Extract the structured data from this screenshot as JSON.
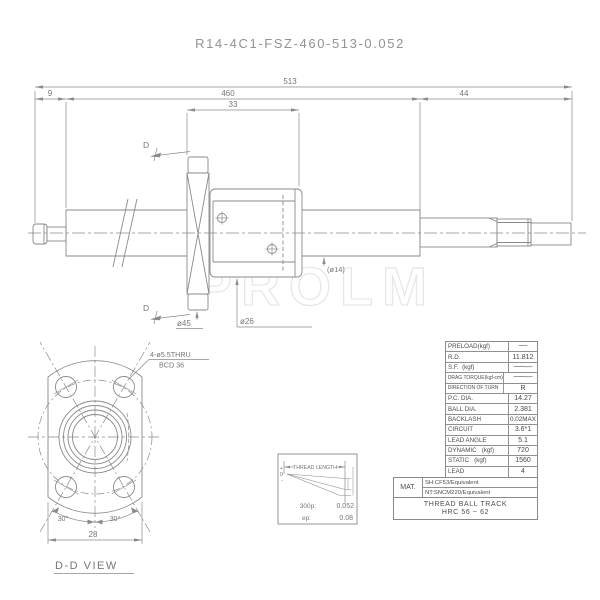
{
  "title": "R14-4C1-FSZ-460-513-0.052",
  "watermark": "PROLM",
  "main_view": {
    "section_marker": "D",
    "dims": {
      "overall": "513",
      "left_end": "9",
      "thread": "460",
      "right_end": "44",
      "nut": "33"
    },
    "labels": {
      "screw_dia": "(ø14)",
      "flange_dia": "ø45",
      "nut_dia": "ø26"
    }
  },
  "dd_view": {
    "title": "D-D VIEW",
    "callout_line1": "4-ø5.5THRU",
    "callout_line2": "BCD 36",
    "width_dim": "28",
    "angle_left": "30°",
    "angle_right": "30°"
  },
  "lead_chart": {
    "title": "THREAD LENGTH",
    "axis": {
      "plus": "+",
      "zero": "0",
      "minus": "-"
    },
    "rows": [
      {
        "label": "300p:",
        "value": "0.052"
      },
      {
        "label": "ep:",
        "value": "0.08"
      }
    ]
  },
  "spec_table": {
    "rows": [
      {
        "label": "PRELOAD(kgf)",
        "value": "~"
      },
      {
        "label": "R.D.",
        "value": "11.812"
      },
      {
        "label": "S.F.  (kgf)",
        "value": "~"
      },
      {
        "label": "DRAG TORQUE(kgf-cm)",
        "value": "~"
      },
      {
        "label": "DIRECTION OF TURN",
        "value": "R"
      },
      {
        "label": "P.C. DIA.",
        "value": "14.27"
      },
      {
        "label": "BALL DIA.",
        "value": "2.381"
      },
      {
        "label": "BACKLASH",
        "value": "0.02MAX"
      },
      {
        "label": "CIRCUIT",
        "value": "3.6*1"
      },
      {
        "label": "LEAD ANGLE",
        "value": "5.1"
      },
      {
        "label": "DYNAMIC   (kgf)",
        "value": "720"
      },
      {
        "label": "STATIC   (kgf)",
        "value": "1560"
      },
      {
        "label": "LEAD",
        "value": "4"
      }
    ]
  },
  "material": {
    "label": "MAT.",
    "line1": "SH:CF53/Equivalent",
    "line2": "NT:SNCM220/Equivalent"
  },
  "hardness": {
    "line1": "THREAD BALL TRACK",
    "line2": "HRC 56 ~ 62"
  },
  "colors": {
    "line": "#8a8a8a",
    "text": "#767676",
    "table_text": "#4d4d4d",
    "watermark": "#e7e7e7"
  }
}
